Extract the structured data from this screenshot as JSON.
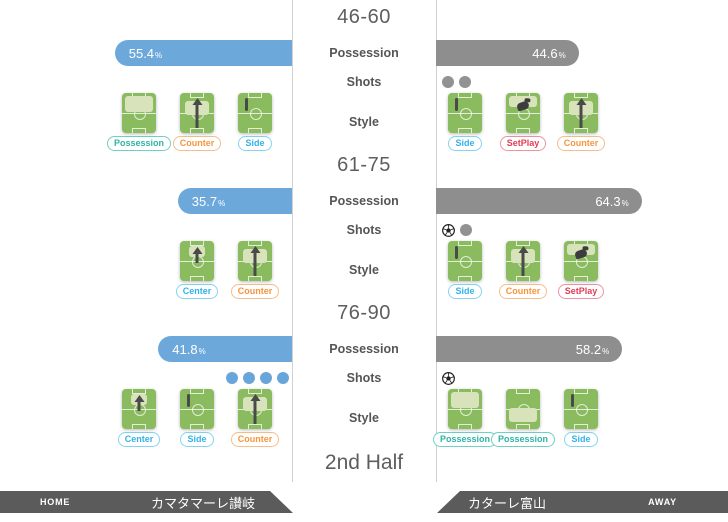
{
  "labels": {
    "possession": "Possession",
    "shots": "Shots",
    "style": "Style",
    "percent": "%"
  },
  "half_label": "2nd Half",
  "footer": {
    "home_tag": "HOME",
    "home_team": "カマタマーレ讃岐",
    "away_tag": "AWAY",
    "away_team": "カターレ富山"
  },
  "colors": {
    "home_bar": "#6da8db",
    "away_bar": "#8e8e8e",
    "home_shot_dot": "#68a5da",
    "away_shot_dot": "#929292",
    "pitch_green": "#8abb5e",
    "pitch_highlight": "#d8e3bc",
    "style_possession": "#2eb5a6",
    "style_counter": "#f5953d",
    "style_side": "#33b2e8",
    "style_center": "#33b2e8",
    "style_setplay": "#e23d55",
    "footer_bar": "#5b5b5b"
  },
  "chart_data": {
    "type": "table",
    "note": "2nd half match stats by 15-minute period",
    "periods": [
      "46-60",
      "61-75",
      "76-90"
    ],
    "possession_home": [
      55.4,
      35.7,
      41.8
    ],
    "possession_away": [
      44.6,
      64.3,
      58.2
    ],
    "shots_home": [
      0,
      0,
      4
    ],
    "shots_away": [
      2,
      2,
      1
    ],
    "goals_home": [
      0,
      0,
      0
    ],
    "goals_away": [
      0,
      1,
      1
    ]
  },
  "blocks": [
    {
      "period": "46-60",
      "home": {
        "possession": 55.4,
        "shots": [],
        "styles": [
          {
            "label": "Possession",
            "kind": "possession-top",
            "color_key": "possession"
          },
          {
            "label": "Counter",
            "kind": "counter",
            "color_key": "counter"
          },
          {
            "label": "Side",
            "kind": "side",
            "color_key": "side"
          }
        ]
      },
      "away": {
        "possession": 44.6,
        "shots": [
          "shot",
          "shot"
        ],
        "styles": [
          {
            "label": "Side",
            "kind": "side",
            "color_key": "side"
          },
          {
            "label": "SetPlay",
            "kind": "setplay",
            "color_key": "setplay"
          },
          {
            "label": "Counter",
            "kind": "counter",
            "color_key": "counter"
          }
        ]
      }
    },
    {
      "period": "61-75",
      "home": {
        "possession": 35.7,
        "shots": [],
        "styles": [
          {
            "label": "Center",
            "kind": "center",
            "color_key": "center"
          },
          {
            "label": "Counter",
            "kind": "counter",
            "color_key": "counter"
          }
        ]
      },
      "away": {
        "possession": 64.3,
        "shots": [
          "goal",
          "shot"
        ],
        "styles": [
          {
            "label": "Side",
            "kind": "side",
            "color_key": "side"
          },
          {
            "label": "Counter",
            "kind": "counter",
            "color_key": "counter"
          },
          {
            "label": "SetPlay",
            "kind": "setplay",
            "color_key": "setplay"
          }
        ]
      }
    },
    {
      "period": "76-90",
      "home": {
        "possession": 41.8,
        "shots": [
          "shot",
          "shot",
          "shot",
          "shot"
        ],
        "styles": [
          {
            "label": "Center",
            "kind": "center",
            "color_key": "center"
          },
          {
            "label": "Side",
            "kind": "side",
            "color_key": "side"
          },
          {
            "label": "Counter",
            "kind": "counter",
            "color_key": "counter"
          }
        ]
      },
      "away": {
        "possession": 58.2,
        "shots": [
          "goal"
        ],
        "styles": [
          {
            "label": "Possession",
            "kind": "possession-top",
            "color_key": "possession"
          },
          {
            "label": "Possession",
            "kind": "possession-bottom",
            "color_key": "possession"
          },
          {
            "label": "Side",
            "kind": "side",
            "color_key": "side"
          }
        ]
      }
    }
  ]
}
